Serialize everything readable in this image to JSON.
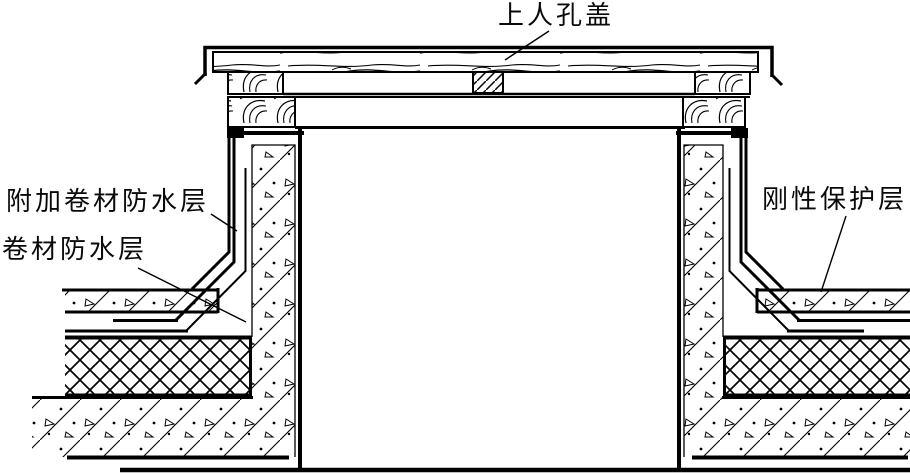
{
  "diagram": {
    "kind": "construction-detail-drawing",
    "labels": {
      "cover": "上人孔盖",
      "additional_membrane": "附加卷材防水层",
      "membrane": "卷材防水层",
      "rigid_protection": "刚性保护层"
    },
    "colors": {
      "line": "#000000",
      "background": "#ffffff"
    },
    "materials": {
      "wood_grain": "cover boards and blocking",
      "diagonal_aggregate": "concrete (curb, protective layer, structural slab)",
      "crosshatch": "insulation layer",
      "fine_diagonal": "center batten block"
    }
  }
}
